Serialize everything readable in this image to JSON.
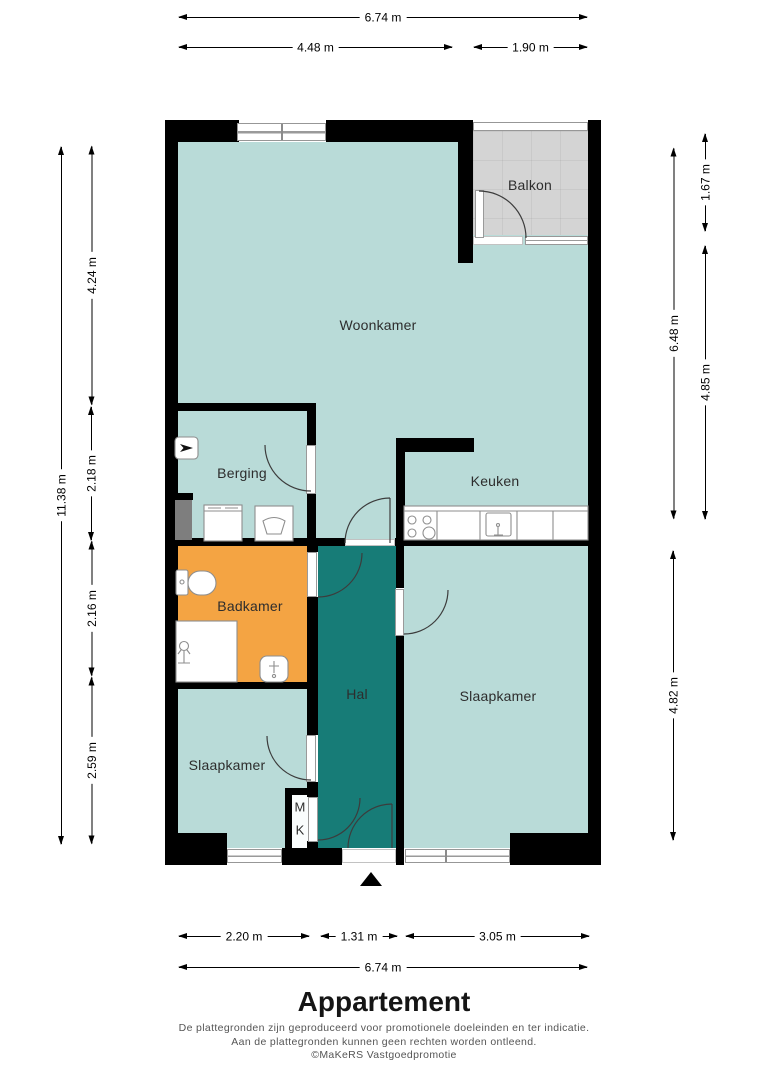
{
  "title": "Appartement",
  "footer": {
    "disclaimer_1": "De plattegronden zijn geproduceerd voor promotionele doeleinden en ter indicatie.",
    "disclaimer_2": "Aan de plattegronden kunnen geen rechten worden ontleend.",
    "credit": "©MaKeRS Vastgoedpromotie"
  },
  "rooms": {
    "woonkamer": "Woonkamer",
    "balkon": "Balkon",
    "berging": "Berging",
    "keuken": "Keuken",
    "badkamer": "Badkamer",
    "hal": "Hal",
    "slaapkamer_right": "Slaapkamer",
    "slaapkamer_left": "Slaapkamer",
    "meterkast_m": "M",
    "meterkast_k": "K"
  },
  "dims": {
    "top_total": "6.74 m",
    "top_left": "4.48 m",
    "top_right": "1.90 m",
    "left_total": "11.38 m",
    "left_1": "4.24 m",
    "left_2": "2.18 m",
    "left_3": "2.16 m",
    "left_4": "2.59 m",
    "right_inner_1": "6.48 m",
    "right_inner_2": "4.82 m",
    "right_outer_1": "1.67 m",
    "right_outer_2": "4.85 m",
    "bottom_1": "2.20 m",
    "bottom_2": "1.31 m",
    "bottom_3": "3.05 m",
    "bottom_total": "6.74 m"
  },
  "colors": {
    "room-fill": "#b9dbd8",
    "hall-fill": "#177c77",
    "bathroom-fill": "#f4a443",
    "balcony-fill": "#d4d4d4",
    "wall": "#000000",
    "dim": "#000000",
    "label": "#2d2d2d"
  }
}
